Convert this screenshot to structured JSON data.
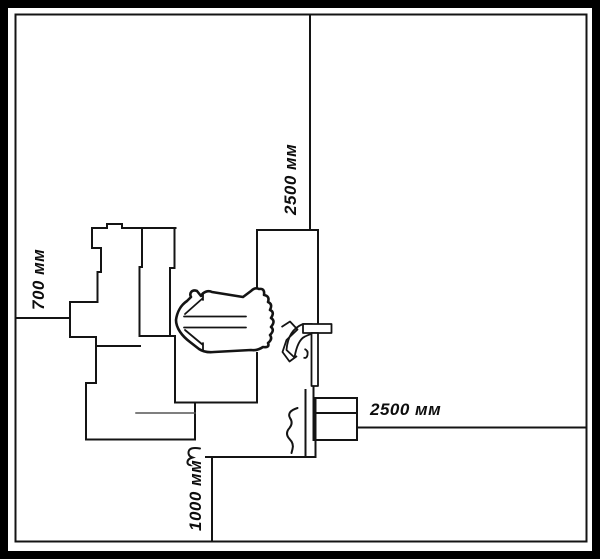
{
  "diagram": {
    "kind": "bathroom floor plan, monochrome line drawing",
    "background": "#ffffff",
    "border_color": "#000000",
    "line_color": "#141414"
  },
  "dimension_labels": {
    "top": "2500 мм",
    "left": "700 мм",
    "right": "2500 мм",
    "bottom": "1000 мм"
  }
}
